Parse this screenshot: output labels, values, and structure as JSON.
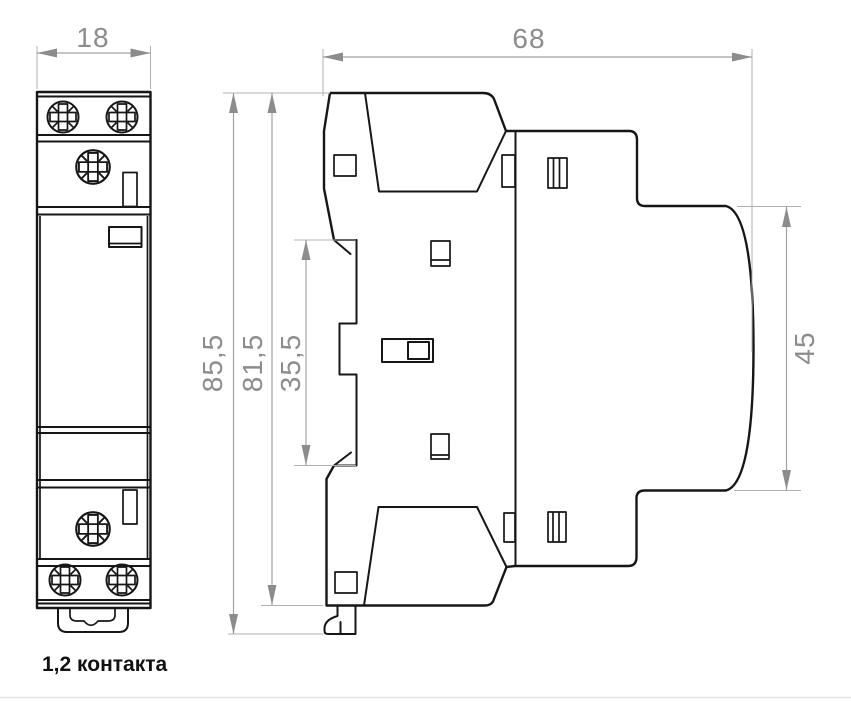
{
  "drawing": {
    "title": "modular-contactor-dimension-drawing",
    "caption": "1,2 контакта",
    "dimensions": {
      "front_width": "18",
      "side_depth": "68",
      "height_overall": "85,5",
      "height_body": "81,5",
      "din_recess_height": "35,5",
      "front_face_height": "45"
    },
    "colors": {
      "outline": "#161616",
      "dimension_lines": "#a2a2a2",
      "dimension_text": "#8c8c8c",
      "caption_text": "#111111",
      "background": "#ffffff"
    }
  }
}
